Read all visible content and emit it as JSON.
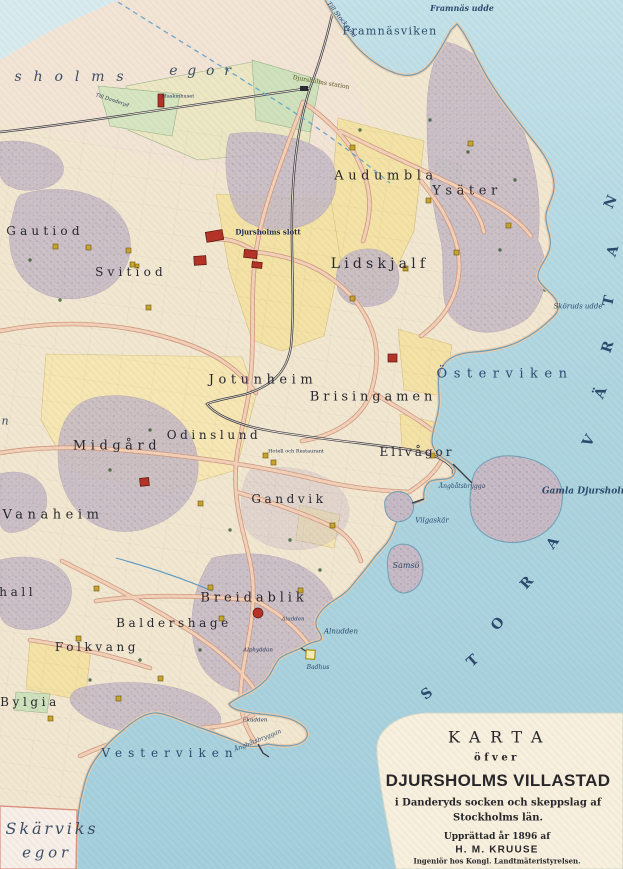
{
  "map_title": "Karta öfver Djursholms Villastad 1896",
  "colors": {
    "water": "#aed6e1",
    "land": "#f2e8d2",
    "hills": "#c7bbc7",
    "roads": "#f3d0b8",
    "yellow_plots": "#f4e3a6",
    "green_plots": "#cfe2bd",
    "building_red": "#b43226",
    "building_yellow": "#c9a52c",
    "ink": "#26262e",
    "water_ink": "#2a4a6e"
  },
  "labels": {
    "egor_left": "sholms",
    "egor_right": "egor",
    "framnas_udde": "Framnäs udde",
    "framnasviken": "Framnäsviken",
    "till_stocksund": "Till Stocksund",
    "till_danderyd": "Till Danderyd",
    "djursholms_station": "Djursholms station",
    "maskinhuset": "Maskinhuset",
    "audumbla": "Audumbla",
    "ysater": "Ysäter",
    "gautiod": "Gautiod",
    "svitiod": "Svitiod",
    "djursholms_slott": "Djursholms slott",
    "lidskjalf": "Lidskjalf",
    "skoruds_udde": "Sköruds udde",
    "osterviken": "Österviken",
    "jotunheim": "Jotunheim",
    "brisingamen": "Brisingamen",
    "odinslund": "Odinslund",
    "midgard": "Midgård",
    "elivagor": "Elivågor",
    "vanaheim": "Vanaheim",
    "gandvik": "Gandvik",
    "gamla_djursholm": "Gamla Djursholm",
    "angbatsbrygga_e": "Ångbåtsbrygga",
    "vilgaskar": "Vilgaskär",
    "samso": "Samsö",
    "hotell": "Hotell och Restaurant",
    "breidablik": "Breidablik",
    "baldershage": "Baldershage",
    "folkvang": "Folkvang",
    "valhall_partial": "lhall",
    "bylgia": "Bylgia",
    "aludden": "Aludden",
    "alnudden": "Alnudden",
    "alphyddan": "Alphyddan",
    "badhus": "Badhus",
    "ekudden": "Ekudden",
    "angbatsbryggan_sw": "Ångbåtsbryggan",
    "vesterviken": "Vesterviken",
    "skarviks": "Skärviks",
    "skarviks_egor": "egor",
    "edge_partial_n": "n"
  },
  "sea_letters": [
    "S",
    "T",
    "O",
    "R",
    "A",
    "V",
    "Ä",
    "R",
    "T",
    "A",
    "N"
  ],
  "cartouche": {
    "karta": "KARTA",
    "ofver": "öfver",
    "main_title": "DJURSHOLMS VILLASTAD",
    "sub1": "i Danderyds socken och skeppslag af",
    "sub2": "Stockholms län.",
    "made": "Upprättad år 1896 af",
    "author": "H. M. KRUUSE",
    "role": "Ingeniör hos Kongl. Landtmäteristyrelsen."
  }
}
